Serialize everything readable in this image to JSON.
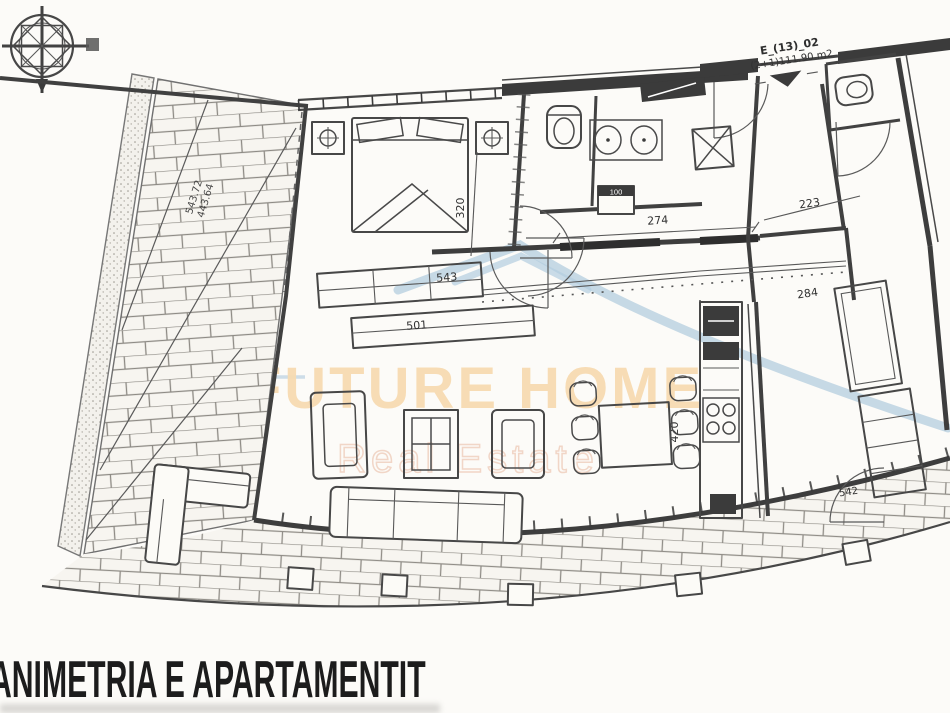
{
  "document": {
    "bottom_title": "ANIMETRIA E APARTAMENTIT"
  },
  "plan": {
    "unit_code": "E_(13)_02",
    "unit_area": "(2+1)111.90 m2",
    "dims": {
      "bedroom_window": "320",
      "corridor": "274",
      "entry_hall": "223",
      "wardrobe_top": "543",
      "wardrobe_mid": "501",
      "kitchen": "420",
      "hall_right": "284",
      "kitchen_right": "542",
      "balcony_outer": "543.72",
      "balcony_inner": "443.64",
      "washer": "100"
    },
    "icons": {
      "compass": "compass-rose-icon"
    }
  },
  "watermark": {
    "brand": "FUTURE HOME",
    "tagline": "Real Estate",
    "brand_color": "#f7dbb2",
    "tagline_color": "#f0d2c2",
    "roof_color": "#b4cddf"
  },
  "colors": {
    "paper": "#fcfbf8",
    "ink": "#3d3d3d",
    "title_ink": "#1c1c1c"
  }
}
